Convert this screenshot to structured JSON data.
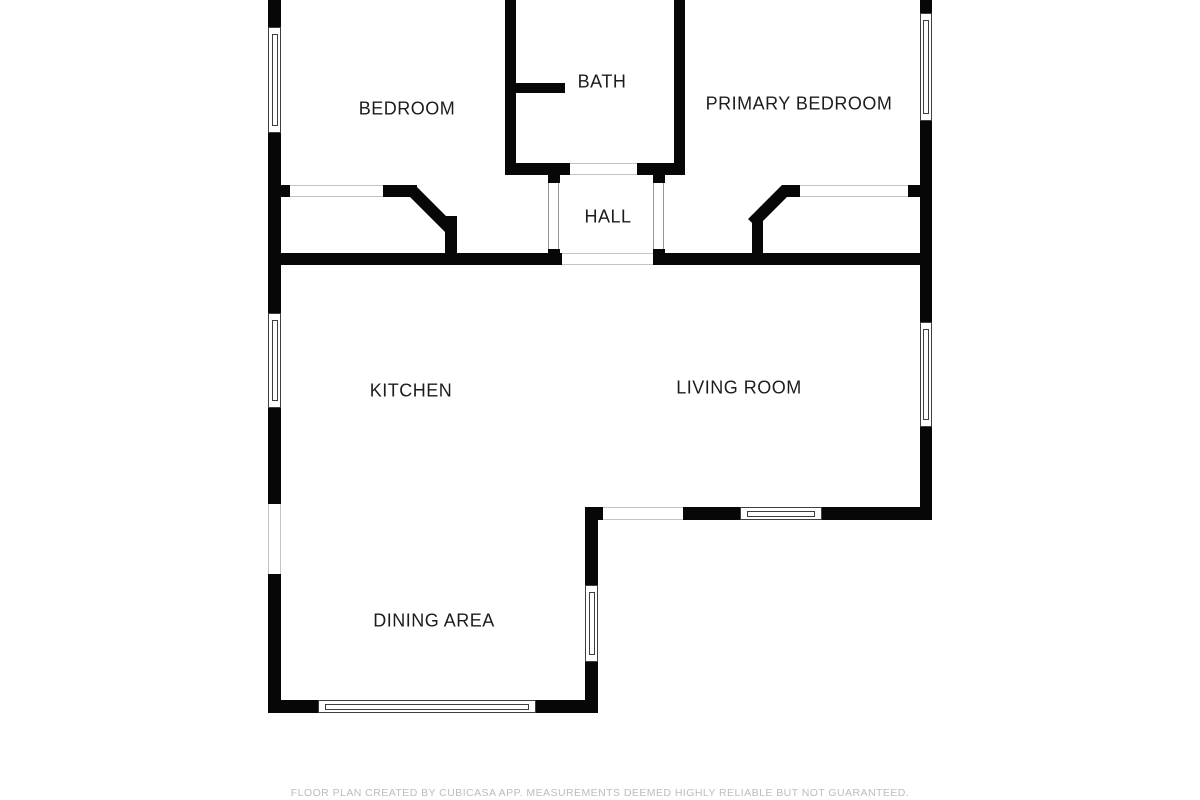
{
  "floor_plan": {
    "rooms": [
      {
        "label": "BEDROOM"
      },
      {
        "label": "BATH"
      },
      {
        "label": "PRIMARY BEDROOM"
      },
      {
        "label": "HALL"
      },
      {
        "label": "KITCHEN"
      },
      {
        "label": "LIVING ROOM"
      },
      {
        "label": "DINING AREA"
      }
    ],
    "footer": "FLOOR PLAN CREATED BY CUBICASA APP. MEASUREMENTS DEEMED HIGHLY RELIABLE BUT NOT GUARANTEED.",
    "window_count": 7,
    "colors": {
      "wall": "#070707",
      "background": "#ffffff",
      "label_text": "#1c1c1c",
      "footer_text": "#bcbcbc",
      "window_frame": "#3f3f3f",
      "opening_outline": "#c4c4c4"
    }
  }
}
